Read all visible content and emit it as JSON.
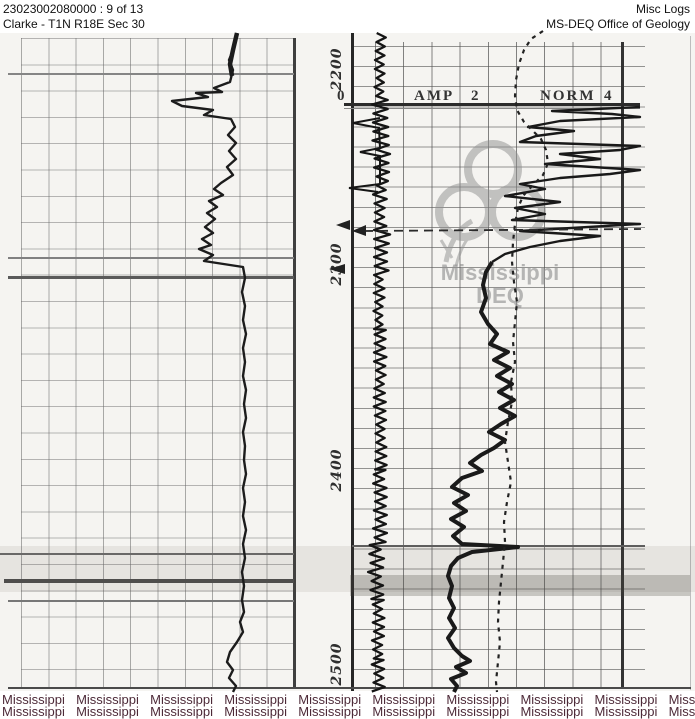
{
  "header": {
    "document_id": "23023002080000 : 9 of 13",
    "well_location": "Clarke - T1N R18E Sec 30",
    "log_type": "Misc Logs",
    "agency": "MS-DEQ Office of Geology"
  },
  "log": {
    "depth_labels": [
      "2200",
      "2300",
      "2400",
      "2500"
    ],
    "scale_zero": "0",
    "curve1_label": "AMP",
    "curve1_scale": "2",
    "curve2_label": "NORM",
    "curve2_scale": "4"
  },
  "watermark": {
    "center_line1": "Mississippi",
    "center_line2": "DEQ",
    "bottom_row1": "Mississippi  Mississippi  Mississippi  Mississippi  Mississippi  Mississippi  Mississippi  Mississippi  Mississippi  Mississippi",
    "bottom_row2": "Mississippi  Mississippi  Mississippi  Mississippi  Mississippi  Mississippi  Mississippi  Mississippi  Mississippi  Mississippi",
    "text_color": "#4d2a38",
    "logo_gray": "#8f8f8f"
  },
  "colors": {
    "ink": "#1c1c1c",
    "paper": "#f5f4f1"
  }
}
